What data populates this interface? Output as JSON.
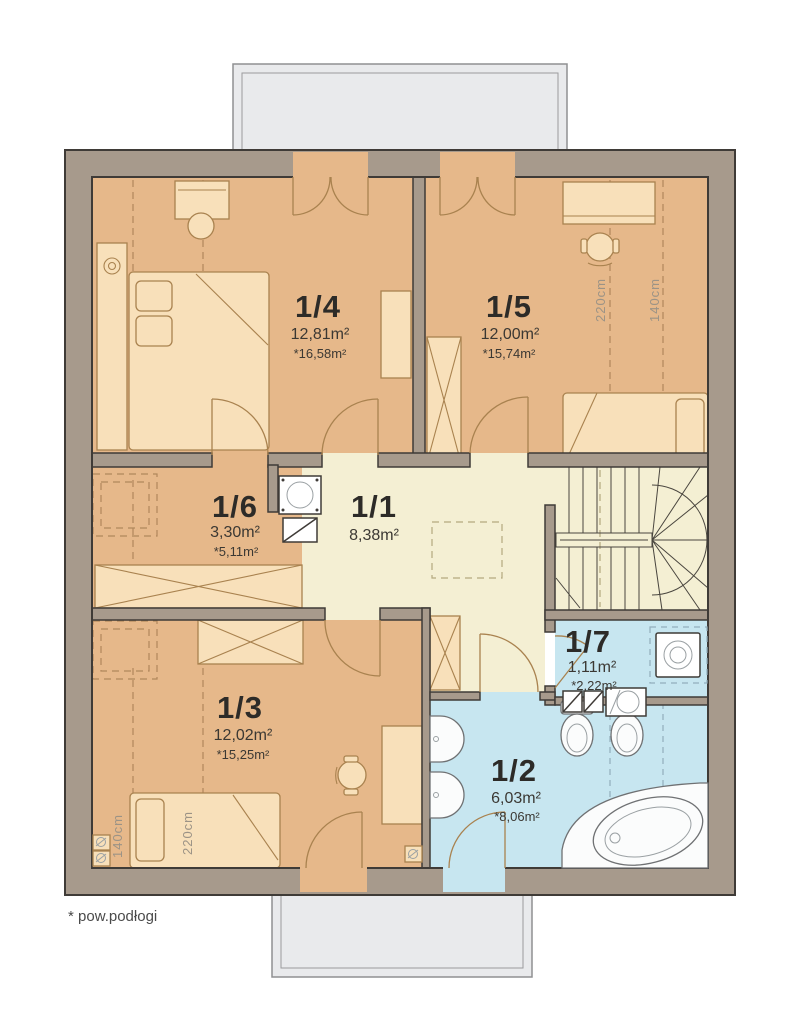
{
  "caption": "* pow.podłogi",
  "rooms": {
    "r11": {
      "number": "1/1",
      "area": "8,38m²"
    },
    "r12": {
      "number": "1/2",
      "area": "6,03m²",
      "floor_area": "*8,06m²"
    },
    "r13": {
      "number": "1/3",
      "area": "12,02m²",
      "floor_area": "*15,25m²"
    },
    "r14": {
      "number": "1/4",
      "area": "12,81m²",
      "floor_area": "*16,58m²"
    },
    "r15": {
      "number": "1/5",
      "area": "12,00m²",
      "floor_area": "*15,74m²"
    },
    "r16": {
      "number": "1/6",
      "area": "3,30m²",
      "floor_area": "*5,11m²"
    },
    "r17": {
      "number": "1/7",
      "area": "1,11m²",
      "floor_area": "*2,22m²"
    }
  },
  "dimensions": {
    "h220": "220cm",
    "h140": "140cm"
  },
  "colors": {
    "wall": "#a79a8c",
    "wall_outline": "#3f3b37",
    "bedroom_floor": "#e6b88a",
    "hall_floor": "#f4efd3",
    "bath_floor": "#c7e6f0",
    "balcony": "#e9eaec",
    "furniture": "#f8e0ba",
    "furniture_line": "#a9824f",
    "dash": "#b1875c"
  }
}
